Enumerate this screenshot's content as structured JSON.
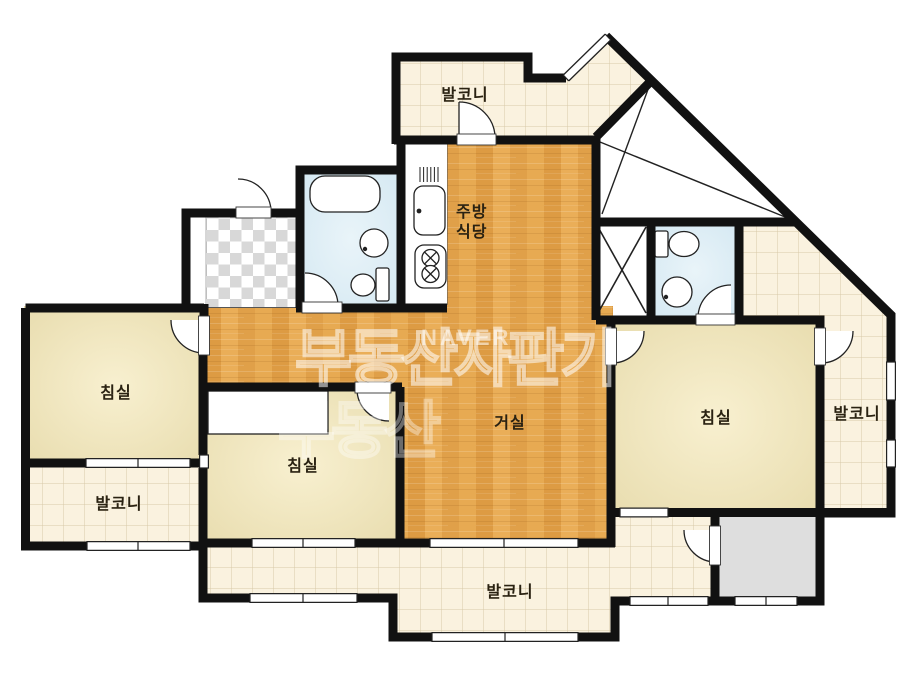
{
  "plan": {
    "rooms": [
      {
        "id": "balcony-top",
        "label": "발코니"
      },
      {
        "id": "kitchen-dining",
        "label_line1": "주방",
        "label_line2": "식당"
      },
      {
        "id": "bedroom-left",
        "label": "침실"
      },
      {
        "id": "balcony-left",
        "label": "발코니"
      },
      {
        "id": "bedroom-middle",
        "label": "침실"
      },
      {
        "id": "living-room",
        "label": "거실"
      },
      {
        "id": "bedroom-right",
        "label": "침실"
      },
      {
        "id": "balcony-right",
        "label": "발코니"
      },
      {
        "id": "balcony-bottom",
        "label": "발코니"
      }
    ],
    "watermark": {
      "brand_outline": "부동산자판기",
      "brand_outline_partial": "부동산",
      "logo": "NAVER"
    },
    "colors": {
      "wall": "#111111",
      "wood_floor": "#e4a64e",
      "bedroom_floor": "#ece0b4",
      "balcony_tile": "#faf2df",
      "tile_grid": "#d8c9a9",
      "bathroom_floor": "#dcedf5",
      "utility_gray": "#dedede",
      "entry_checker": "#d8d8d8",
      "label_text": "#2a2212"
    }
  }
}
